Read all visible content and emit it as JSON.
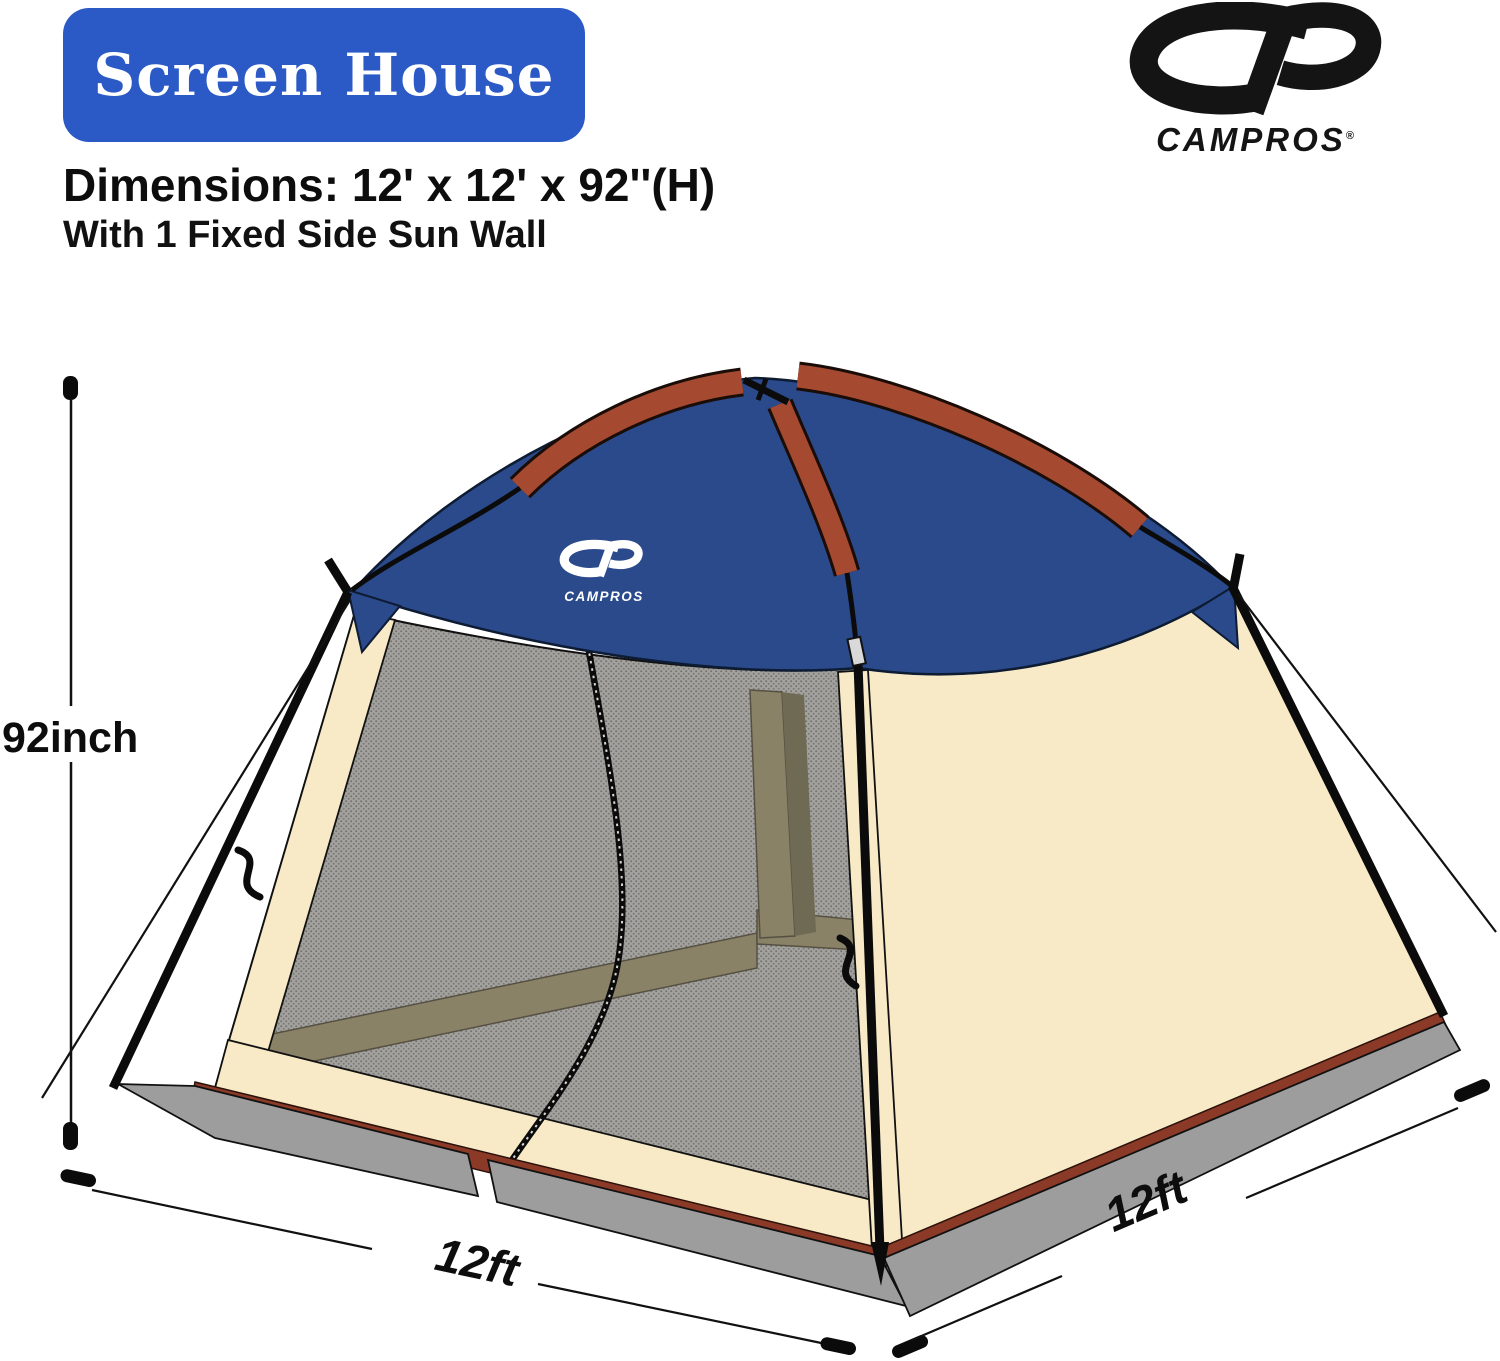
{
  "header": {
    "badge_label": "Screen House",
    "dimensions_line": "Dimensions: 12' x 12' x 92''(H)",
    "feature_line": "With 1 Fixed Side Sun Wall"
  },
  "brand": {
    "name": "CAMPROS",
    "reg_mark": "®"
  },
  "canopy_brand": {
    "name": "CAMPROS"
  },
  "annotations": {
    "height": "92inch",
    "front_width": "12ft",
    "side_depth": "12ft"
  },
  "colors": {
    "badge_blue": "#2b5ac6",
    "canopy_blue": "#2b4a8b",
    "pole_sleeve_red": "#a54a31",
    "base_strip_red": "#8a3a27",
    "wall_tan": "#f8eac6",
    "skirt_gray": "#9d9d9d",
    "mesh_gray": "#a3a29f",
    "interior_khaki": "#8a8266",
    "pole_black": "#0b0b0b"
  }
}
